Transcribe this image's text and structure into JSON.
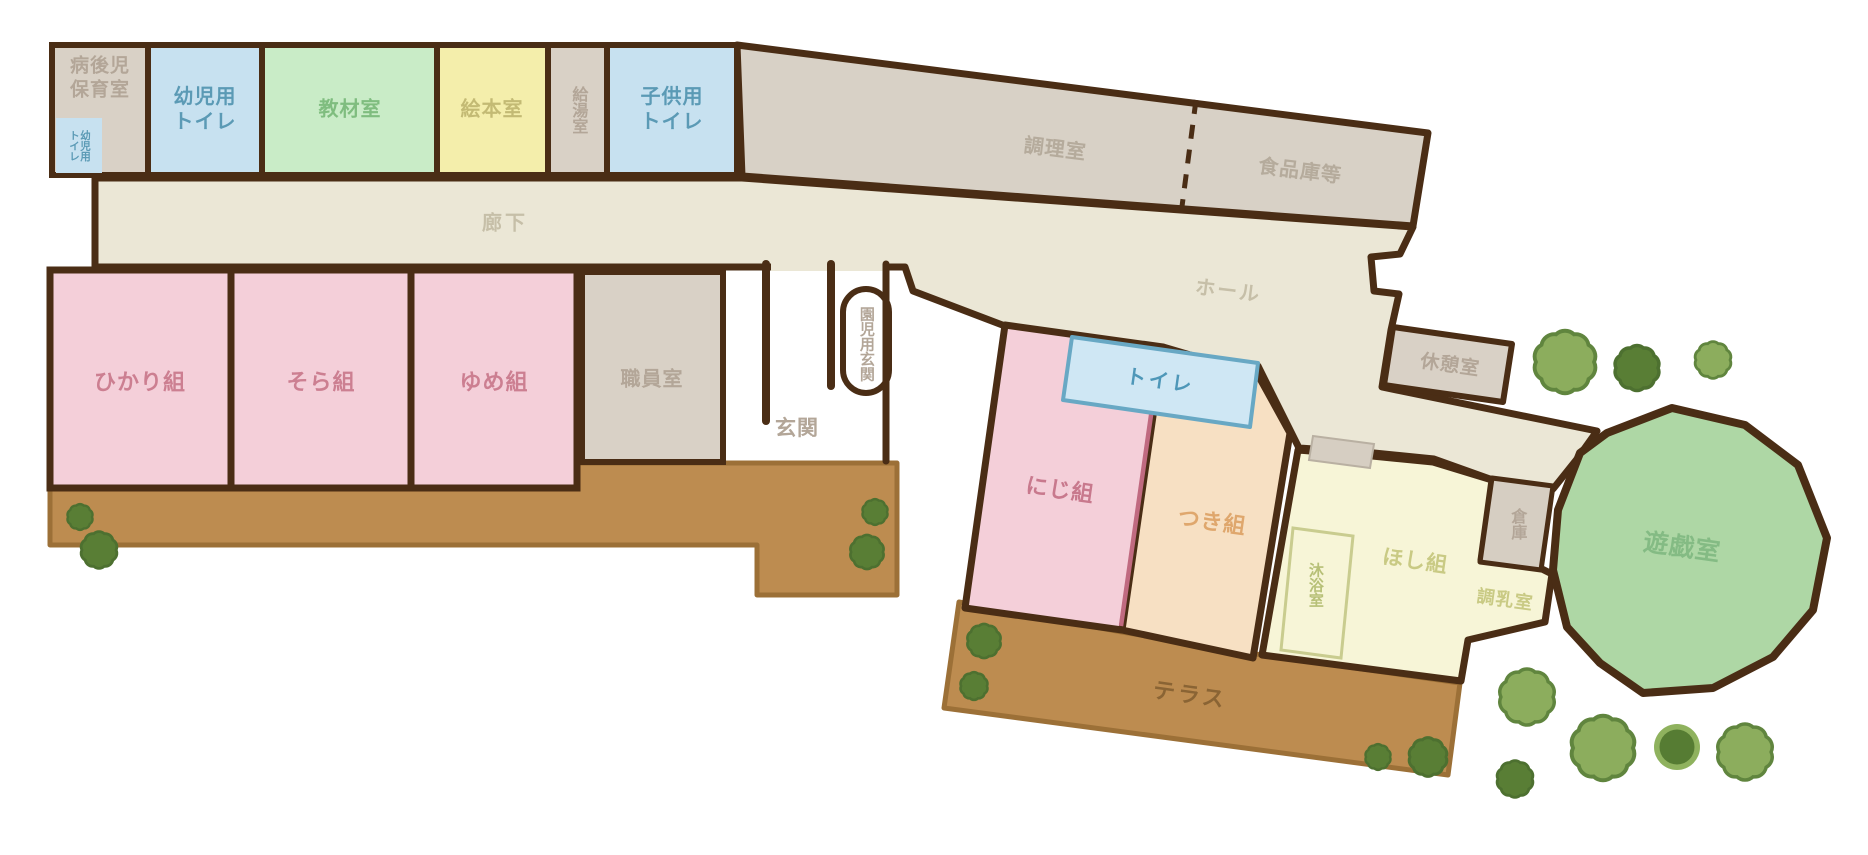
{
  "colors": {
    "wall": "#4a2d15",
    "room_gray": "#d9d1c6",
    "room_blue": "#c7e1f0",
    "room_green": "#c9ecc7",
    "room_yellow": "#f4eeab",
    "kitchen": "#d8d1c6",
    "corridor": "#ebe7d6",
    "room_pink": "#f4cfd9",
    "room_peach": "#f7e0c3",
    "room_paleyellow": "#f7f5d7",
    "small_gray": "#d6cec2",
    "terrace": "#bd8c50",
    "terrace_stroke": "#9c7037",
    "playroom": "#aed7a5",
    "toilet_fill": "#cfe7f4",
    "toilet_stroke": "#68a8c4",
    "divider_rose": "#c06a80",
    "tree_light": "#8cad5d",
    "tree_light_stroke": "#60853e",
    "tree_dark": "#597e35",
    "tree_dark_stroke": "#4d7030"
  },
  "rooms": {
    "byogoji_hoikushitsu": {
      "label": "病後児\n保育室"
    },
    "yoji_toilet_small": {
      "label": "幼児用トイレ"
    },
    "yoji_toilet": {
      "label": "幼児用\nトイレ"
    },
    "kyozaishitsu": {
      "label": "教材室"
    },
    "ehonshitsu": {
      "label": "絵本室"
    },
    "kyutoshitsu": {
      "label": "給湯室"
    },
    "kodomoyo_toilet": {
      "label": "子供用\nトイレ"
    },
    "chorishitsu": {
      "label": "調理室"
    },
    "shokuhinko": {
      "label": "食品庫等"
    },
    "roka": {
      "label": "廊下"
    },
    "hall": {
      "label": "ホール"
    },
    "hikari": {
      "label": "ひかり組"
    },
    "sora": {
      "label": "そら組"
    },
    "yume": {
      "label": "ゆめ組"
    },
    "shokuinshitsu": {
      "label": "職員室"
    },
    "genkan": {
      "label": "玄関"
    },
    "enjiyo_genkan": {
      "label": "園児用玄関"
    },
    "kyukeishitsu": {
      "label": "休憩室"
    },
    "toilet_east": {
      "label": "トイレ"
    },
    "niji": {
      "label": "にじ組"
    },
    "tsuki": {
      "label": "つき組"
    },
    "mokuyokushitsu": {
      "label": "沐浴室"
    },
    "hoshi": {
      "label": "ほし組"
    },
    "soko": {
      "label": "倉庫"
    },
    "chonyushitsu": {
      "label": "調乳室"
    },
    "yugishitsu": {
      "label": "遊戯室"
    },
    "terrace": {
      "label": "テラス"
    }
  },
  "site": {
    "trees_count": 16
  }
}
